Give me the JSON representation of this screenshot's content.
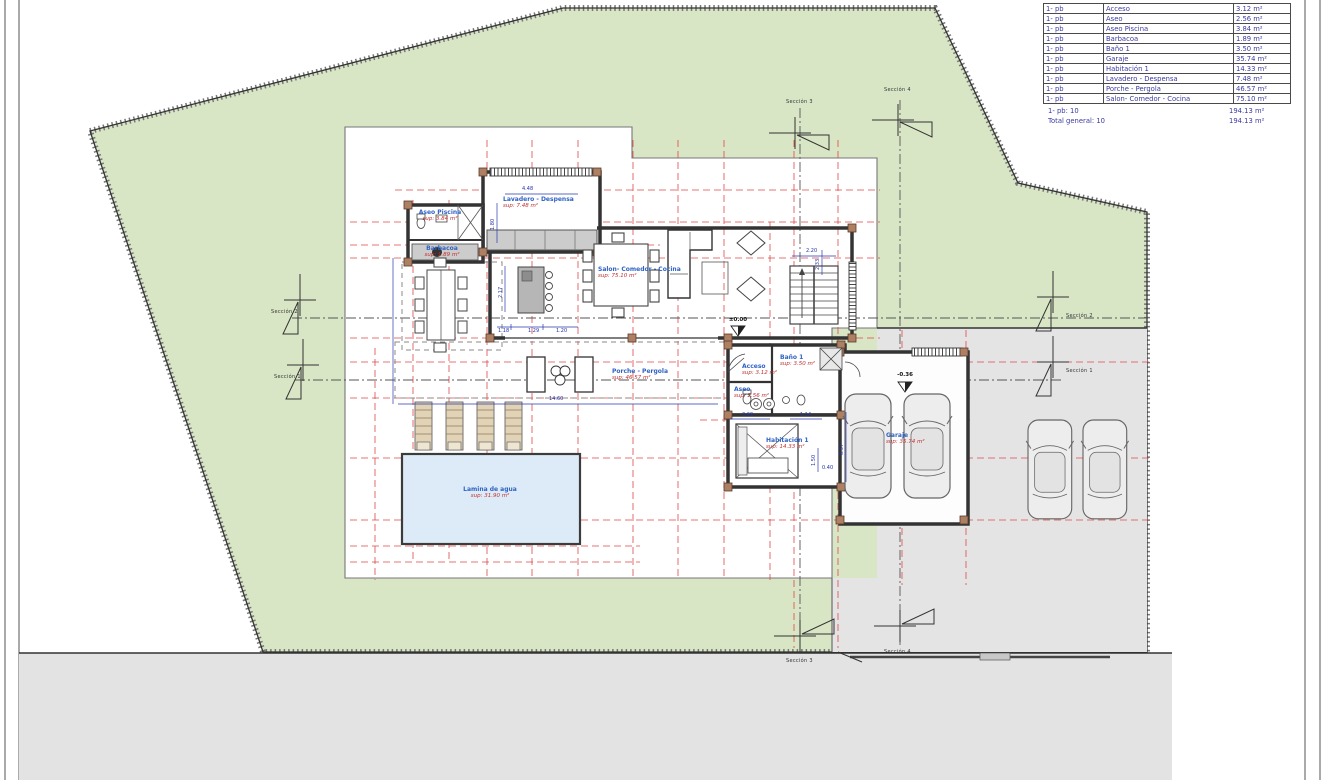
{
  "drawing": {
    "type": "architectural-floor-plan",
    "floor_code": "1- pb"
  },
  "colors": {
    "garden_green": "#d8e6c6",
    "paving_gray": "#e4e4e4",
    "pool_blue": "#dcebf7",
    "grid_red": "#e04848",
    "dim_blue": "#2233aa",
    "label_blue": "#2f62c4",
    "sup_red": "#c03030",
    "wall_dark": "#333333",
    "pier_brown": "#ad7f63"
  },
  "area_table": {
    "rows": [
      {
        "floor": "1- pb",
        "room": "Acceso",
        "area": "3.12 m²"
      },
      {
        "floor": "1- pb",
        "room": "Aseo",
        "area": "2.56 m²"
      },
      {
        "floor": "1- pb",
        "room": "Aseo Piscina",
        "area": "3.84 m²"
      },
      {
        "floor": "1- pb",
        "room": "Barbacoa",
        "area": "1.89 m²"
      },
      {
        "floor": "1- pb",
        "room": "Baño 1",
        "area": "3.50 m²"
      },
      {
        "floor": "1- pb",
        "room": "Garaje",
        "area": "35.74 m²"
      },
      {
        "floor": "1- pb",
        "room": "Habitación 1",
        "area": "14.33 m²"
      },
      {
        "floor": "1- pb",
        "room": "Lavadero  -  Despensa",
        "area": "7.48 m²"
      },
      {
        "floor": "1- pb",
        "room": "Porche - Pergola",
        "area": "46.57 m²"
      },
      {
        "floor": "1- pb",
        "room": "Salon- Comedor - Cocina",
        "area": "75.10 m²"
      }
    ],
    "subtotal_label": "1- pb: 10",
    "subtotal_area": "194.13 m²",
    "total_label": "Total general: 10",
    "total_area": "194.13 m²"
  },
  "rooms": [
    {
      "name": "Aseo Piscina",
      "sup": "sup: 3.84 m²"
    },
    {
      "name": "Lavadero  -  Despensa",
      "sup": "sup: 7.48 m²"
    },
    {
      "name": "Barbacoa",
      "sup": "sup: 1.89 m²"
    },
    {
      "name": "Salon- Comedor - Cocina",
      "sup": "sup: 75.10 m²"
    },
    {
      "name": "Porche - Pergola",
      "sup": "sup: 46.57 m²"
    },
    {
      "name": "Acceso",
      "sup": "sup: 3.12 m²"
    },
    {
      "name": "Aseo",
      "sup": "sup: 2.56 m²"
    },
    {
      "name": "Baño 1",
      "sup": "sup: 3.50 m²"
    },
    {
      "name": "Habitación 1",
      "sup": "sup: 14.33 m²"
    },
    {
      "name": "Garaje",
      "sup": "sup: 35.74 m²"
    },
    {
      "name": "Lamina de agua",
      "sup": "sup: 31.90 m²"
    }
  ],
  "levels": {
    "ground": "±0.00",
    "garage": "-0.36"
  },
  "sections": {
    "s1": "Sección 1",
    "s2": "Sección 2",
    "s3": "Sección 3",
    "s4": "Sección 4"
  },
  "dims": {
    "d448": "4.48",
    "d180": "1.80",
    "d217": "2.17",
    "d118": "1.18",
    "d129": "1.29",
    "d120": "1.20",
    "d1460": "14.60",
    "d220": "2.20",
    "d233": "2.33",
    "d369": "3.69",
    "d114": "1.14",
    "d150": "1.50",
    "d040": "0.40",
    "d857": "8.57"
  }
}
